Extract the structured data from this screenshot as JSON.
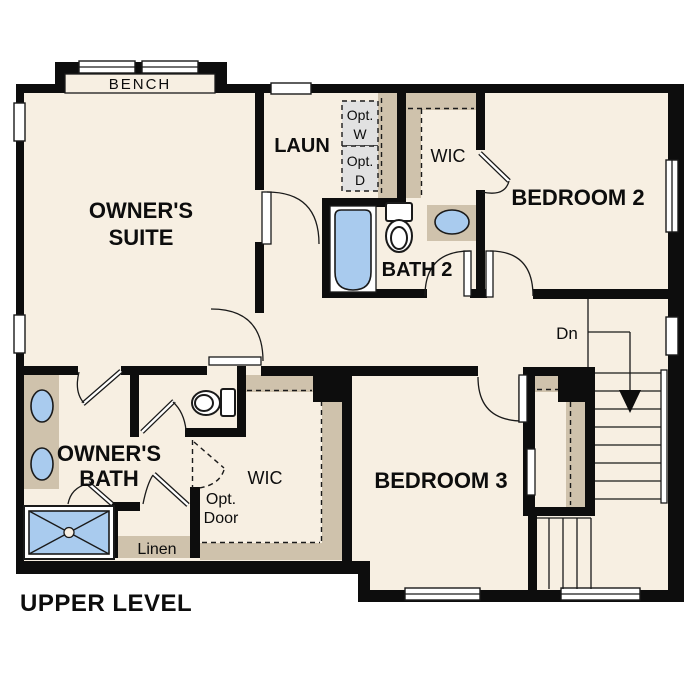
{
  "colors": {
    "wall": "#0d0d0d",
    "floor": "#f7efe2",
    "casework": "#cfc2ac",
    "optional_grey": "#e1e1e1",
    "fixture_blue": "#a9cbee",
    "line": "#1a1a1a",
    "background": "#ffffff"
  },
  "labels": {
    "bench": "BENCH",
    "owners_suite_1": "OWNER'S",
    "owners_suite_2": "SUITE",
    "laundry": "LAUN",
    "opt_washer_1": "Opt.",
    "opt_washer_2": "W",
    "opt_dryer_1": "Opt.",
    "opt_dryer_2": "D",
    "wic_upper": "WIC",
    "bedroom2": "BEDROOM 2",
    "bath2": "BATH 2",
    "stairs_down": "Dn",
    "owners_bath_1": "OWNER'S",
    "owners_bath_2": "BATH",
    "wic_lower": "WIC",
    "opt_door_1": "Opt.",
    "opt_door_2": "Door",
    "linen": "Linen",
    "bedroom3": "BEDROOM 3",
    "plan_title": "UPPER LEVEL"
  }
}
